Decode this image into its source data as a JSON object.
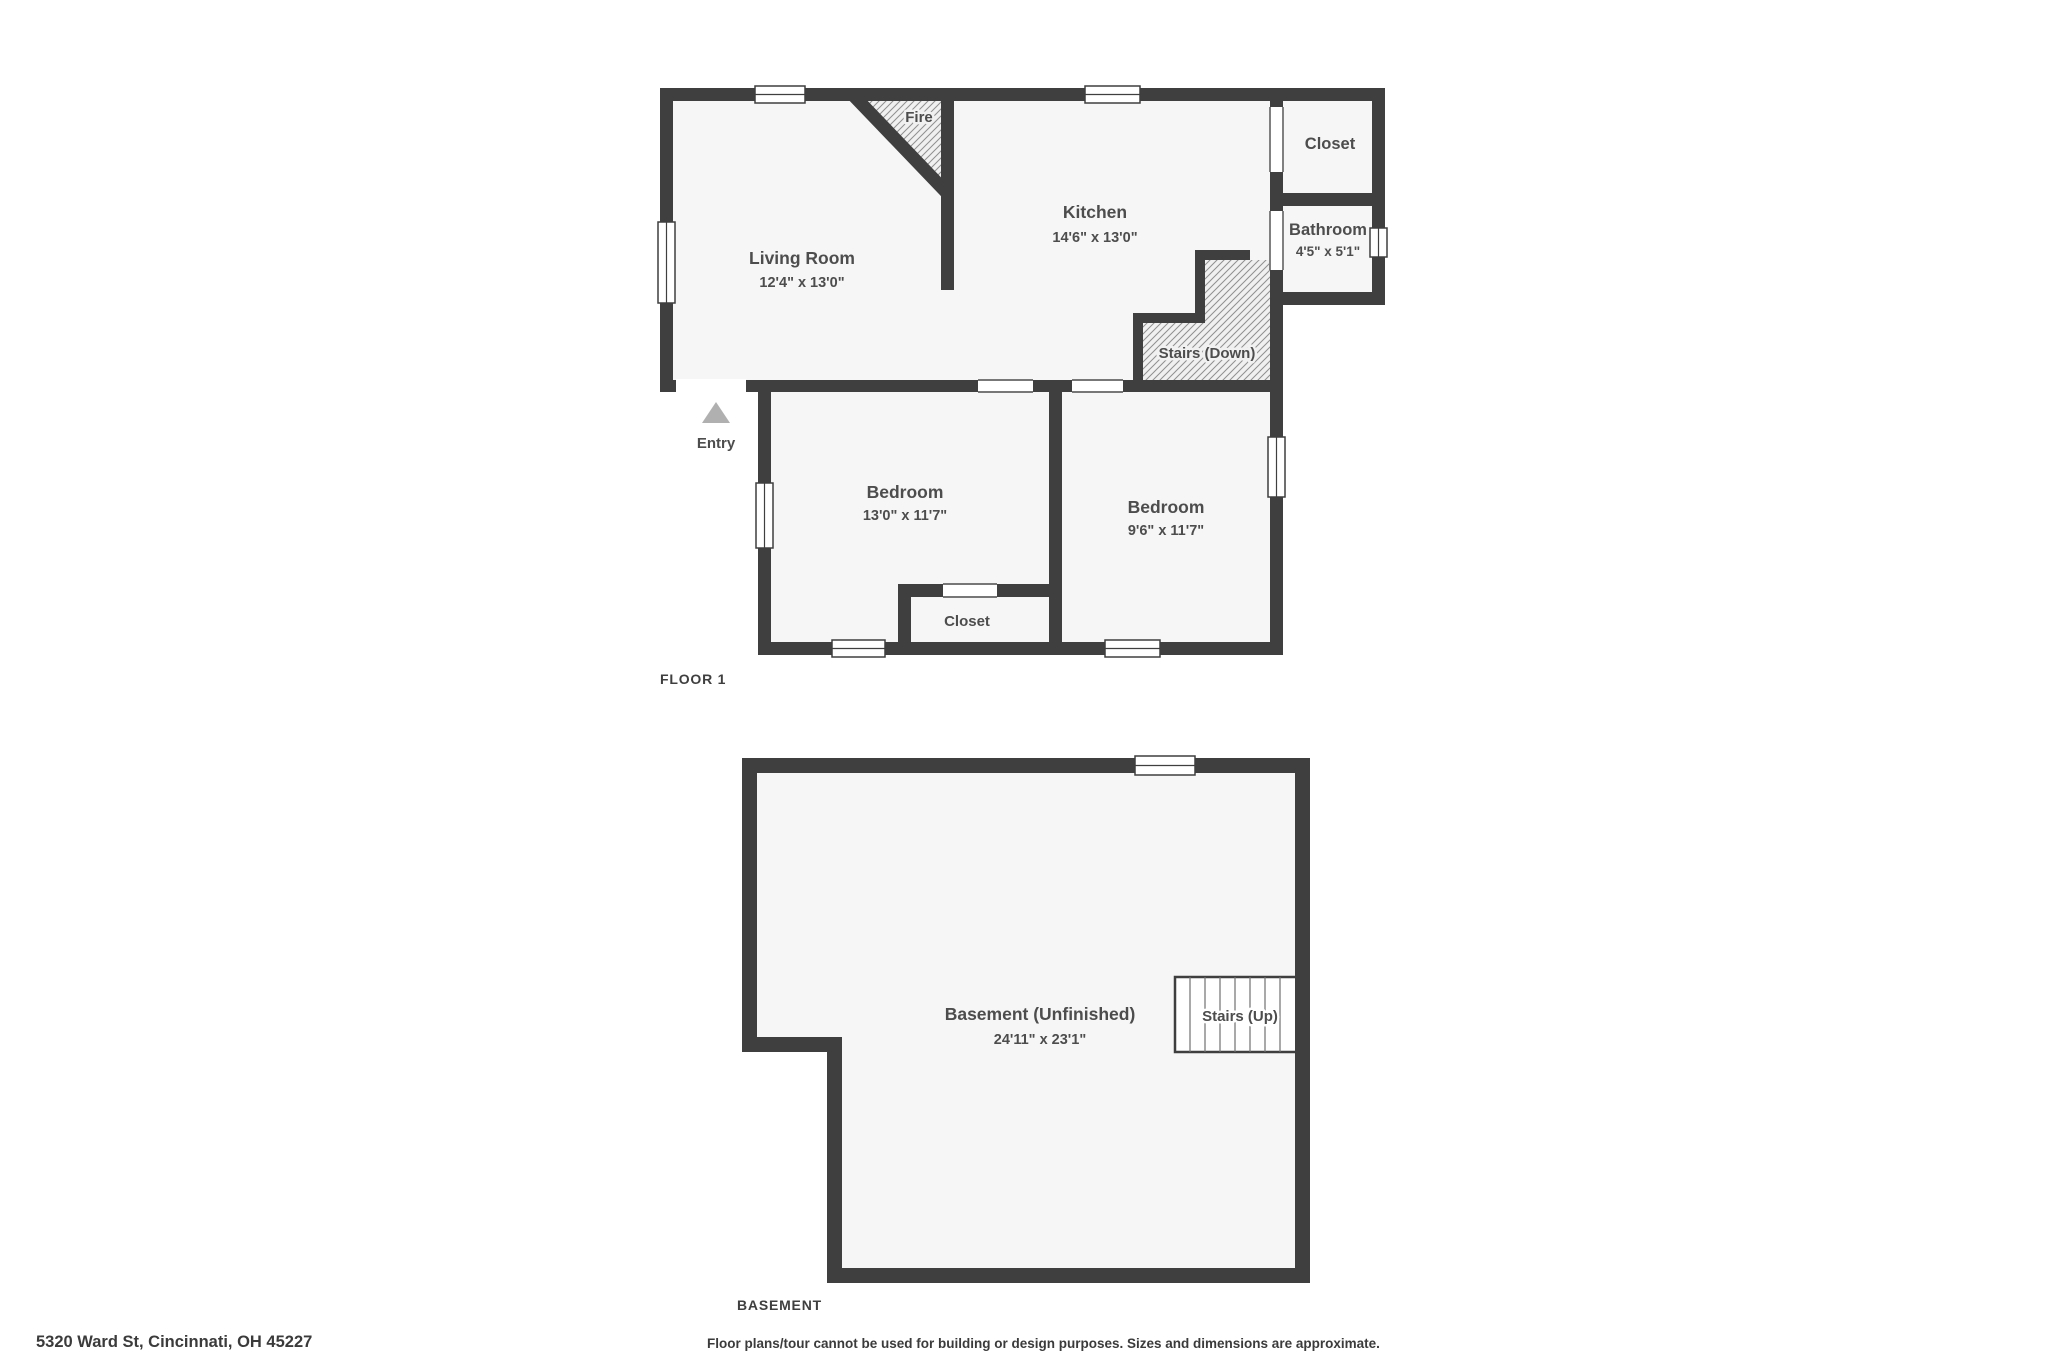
{
  "colors": {
    "wall": "#3f3f3f",
    "room_fill": "#f6f6f6",
    "hatch_bg": "#f0f0f0",
    "hatch_line": "#8f8f8f",
    "entry_arrow": "#b0b0b0",
    "label_text": "#4d4d4d",
    "footer_text": "#3b3b3b"
  },
  "floor1": {
    "label": "FLOOR 1",
    "living_room": {
      "name": "Living Room",
      "dims": "12'4\" x 13'0\""
    },
    "kitchen": {
      "name": "Kitchen",
      "dims": "14'6\" x 13'0\""
    },
    "closet_top": {
      "name": "Closet"
    },
    "bathroom": {
      "name": "Bathroom",
      "dims": "4'5\" x 5'1\""
    },
    "stairs_down": {
      "name": "Stairs (Down)"
    },
    "fireplace": {
      "name": "Fire"
    },
    "entry": {
      "name": "Entry"
    },
    "bedroom_left": {
      "name": "Bedroom",
      "dims": "13'0\" x 11'7\""
    },
    "bedroom_right": {
      "name": "Bedroom",
      "dims": "9'6\" x 11'7\""
    },
    "closet_bottom": {
      "name": "Closet"
    }
  },
  "basement": {
    "label": "BASEMENT",
    "room": {
      "name": "Basement (Unfinished)",
      "dims": "24'11\" x 23'1\""
    },
    "stairs_up": {
      "name": "Stairs (Up)"
    }
  },
  "footer": {
    "address": "5320 Ward St, Cincinnati, OH 45227",
    "disclaimer": "Floor plans/tour cannot be used for building or design purposes. Sizes and dimensions are approximate."
  }
}
